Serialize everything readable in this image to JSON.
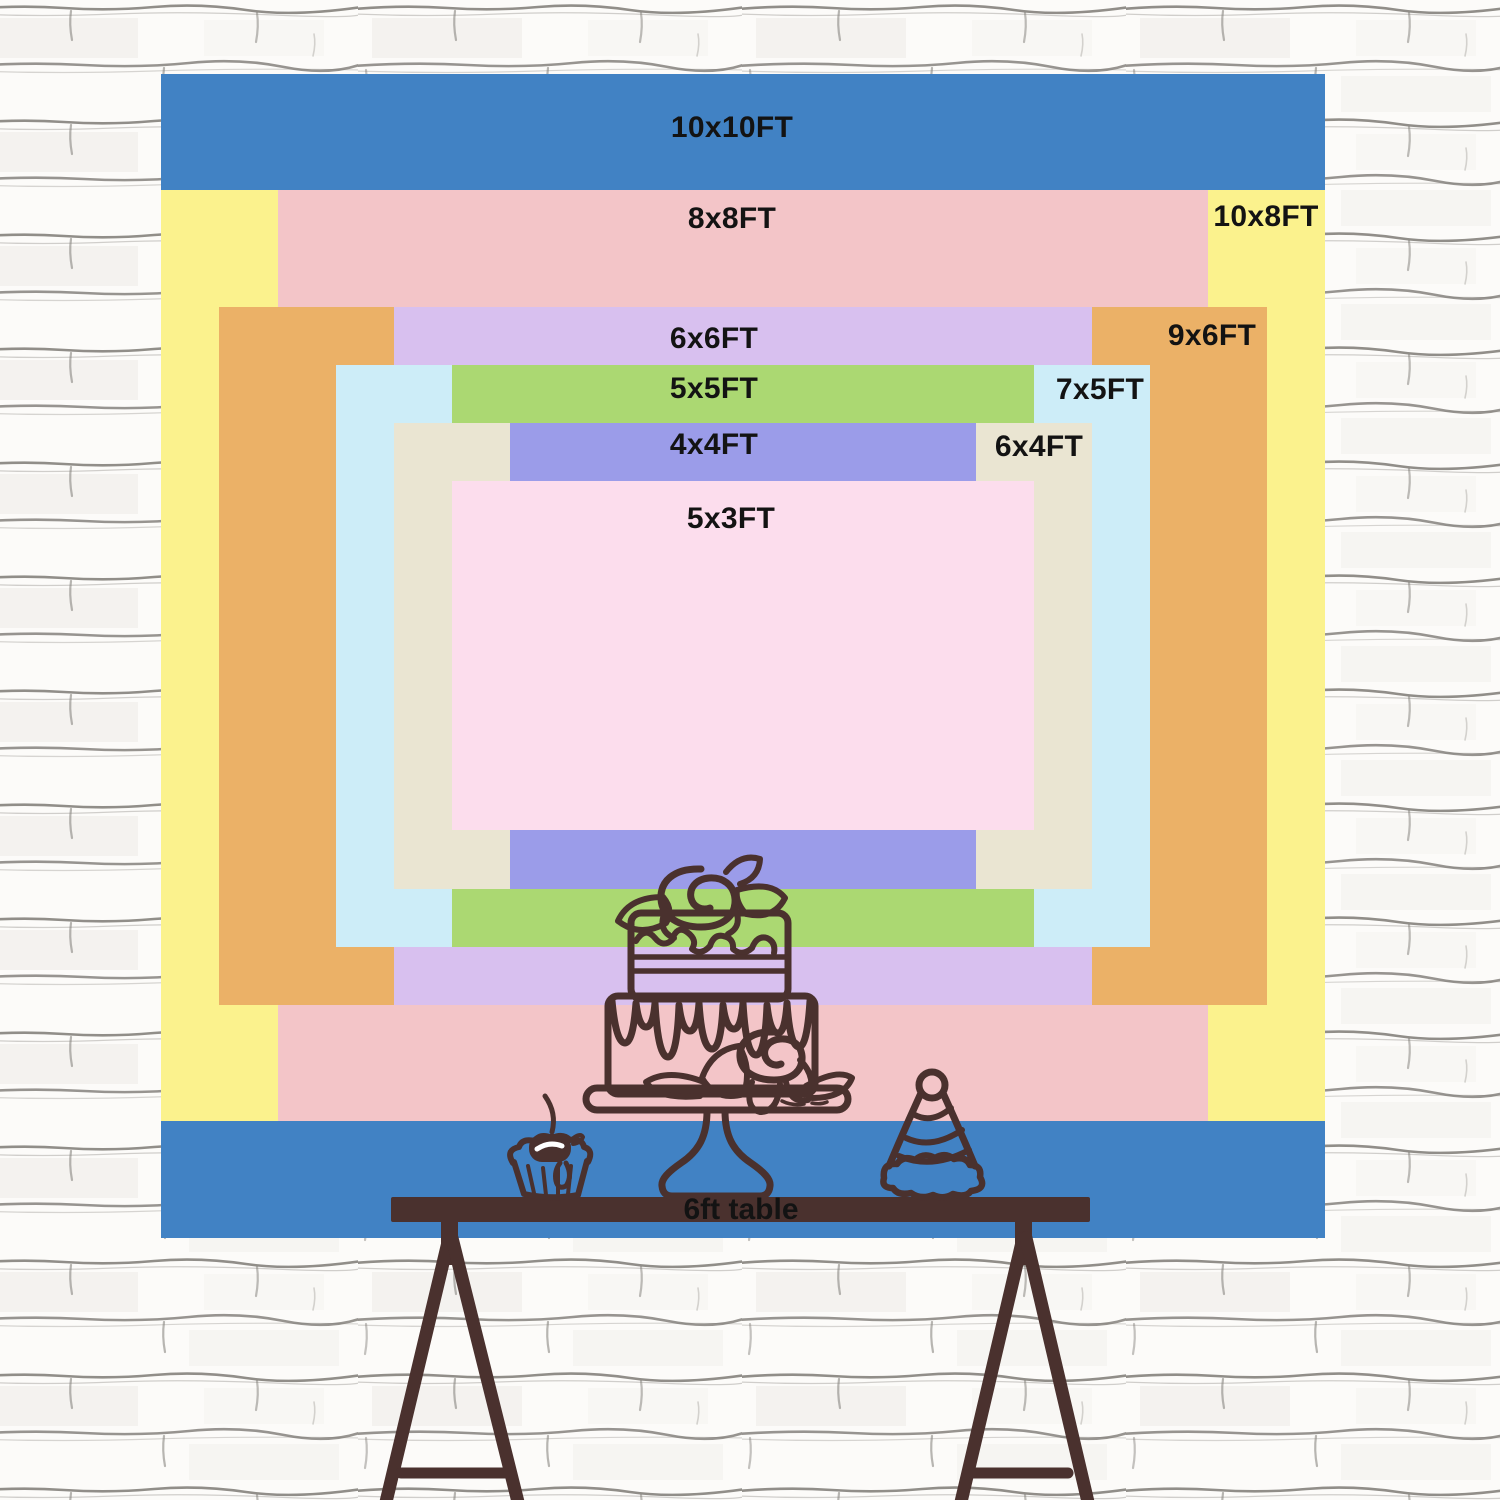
{
  "image_type": "backdrop size comparison chart on white brick wall",
  "sizes": [
    {
      "label": "10x10FT",
      "width_ft": 10,
      "height_ft": 10,
      "color": "#4182c4"
    },
    {
      "label": "10x8FT",
      "width_ft": 10,
      "height_ft": 8,
      "color": "#fbf28d"
    },
    {
      "label": "8x8FT",
      "width_ft": 8,
      "height_ft": 8,
      "color": "#f3c5c8"
    },
    {
      "label": "9x6FT",
      "width_ft": 9,
      "height_ft": 6,
      "color": "#ebb167"
    },
    {
      "label": "6x6FT",
      "width_ft": 6,
      "height_ft": 6,
      "color": "#d8c0ef"
    },
    {
      "label": "7x5FT",
      "width_ft": 7,
      "height_ft": 5,
      "color": "#cdedf8"
    },
    {
      "label": "5x5FT",
      "width_ft": 5,
      "height_ft": 5,
      "color": "#abd872"
    },
    {
      "label": "6x4FT",
      "width_ft": 6,
      "height_ft": 4,
      "color": "#eae5d2"
    },
    {
      "label": "4x4FT",
      "width_ft": 4,
      "height_ft": 4,
      "color": "#9b9ce9"
    },
    {
      "label": "5x3FT",
      "width_ft": 5,
      "height_ft": 3,
      "color": "#fcdded"
    }
  ],
  "table": {
    "label": "6ft table",
    "color": "#4a312e"
  },
  "illustration": {
    "line_color": "#4a312e",
    "items": [
      "cupcake with cherry",
      "two-tier cake with roses on stand",
      "party hat"
    ]
  },
  "label_text_color": "#131313",
  "wall": {
    "background": "#fcfbf9",
    "mortar_line": "#7e7b76"
  }
}
